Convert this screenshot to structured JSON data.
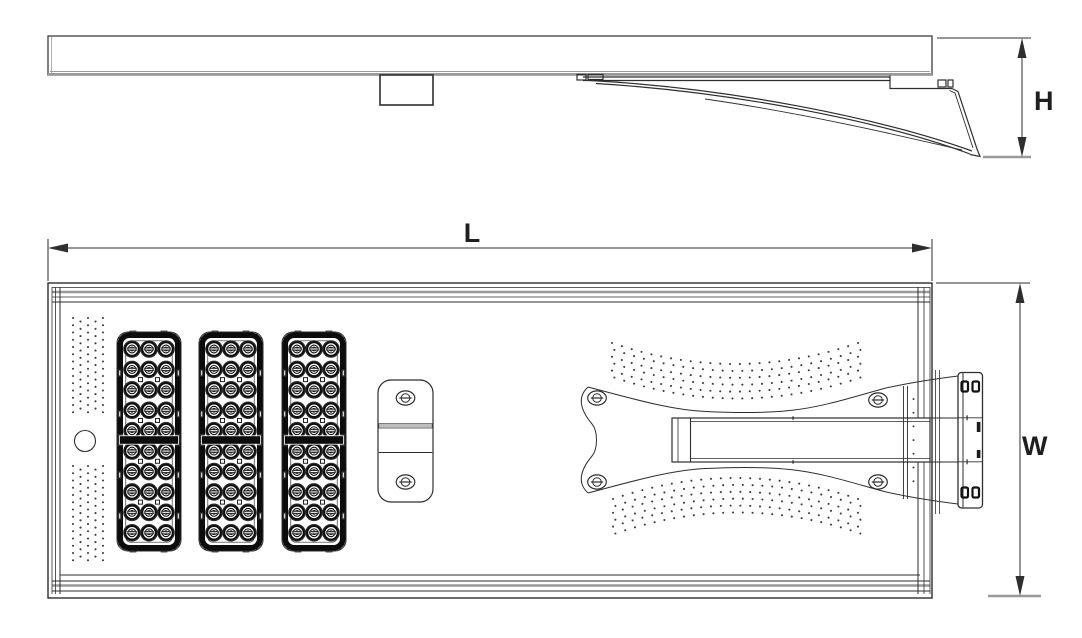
{
  "drawing": {
    "dimensions": {
      "height_label": "H",
      "length_label": "L",
      "width_label": "W"
    },
    "components": {
      "led_modules": 3,
      "led_columns_per_module": 3,
      "led_rows_per_module": 10,
      "bracket_screw_holes": 4,
      "cover_plate_screws": 2
    },
    "colors": {
      "line": "#2e2e2e",
      "soft_line": "#9a9a9a",
      "led_black": "#0c0c0c",
      "dot": "#3d3d3d",
      "background": "#ffffff"
    }
  }
}
